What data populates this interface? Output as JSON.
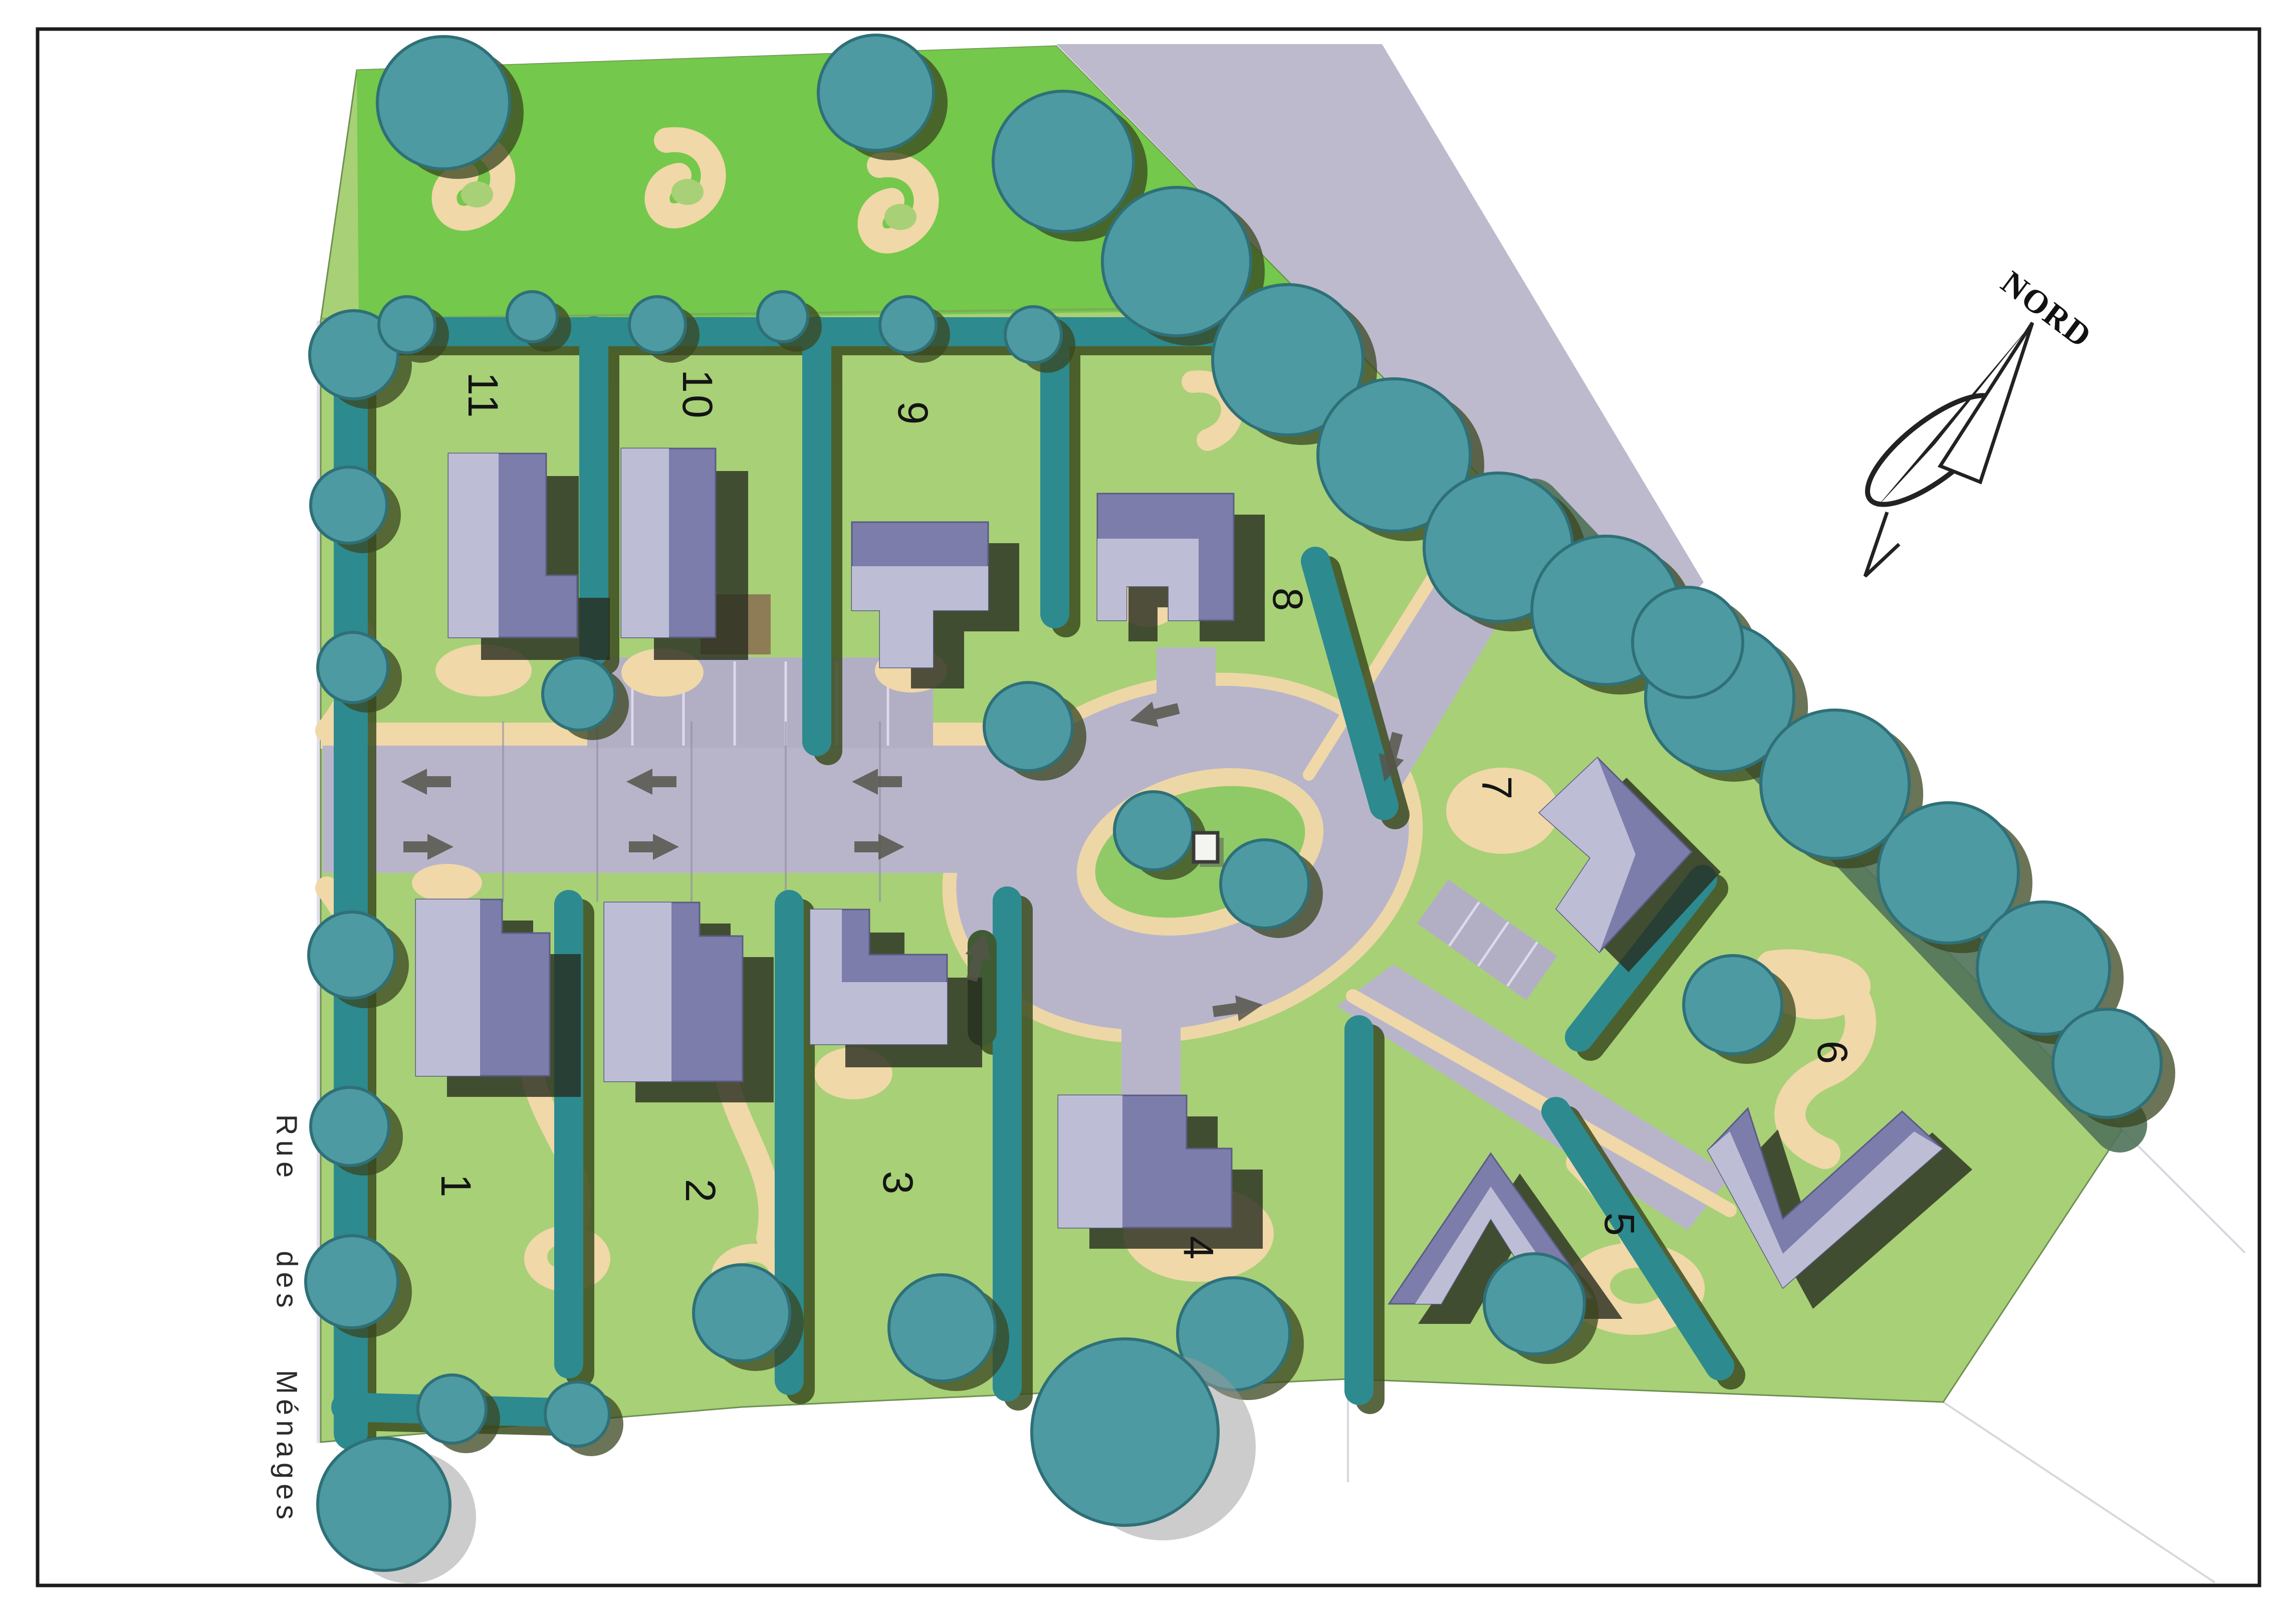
{
  "page": {
    "background": "#ffffff",
    "frame_color": "#1c1c1c"
  },
  "compass": {
    "label": "NORD"
  },
  "street": {
    "word1": "Rue",
    "word2": "des",
    "word3": "Ménages"
  },
  "lots": [
    {
      "number": "1"
    },
    {
      "number": "2"
    },
    {
      "number": "3"
    },
    {
      "number": "4"
    },
    {
      "number": "5"
    },
    {
      "number": "6"
    },
    {
      "number": "7"
    },
    {
      "number": "8"
    },
    {
      "number": "9"
    },
    {
      "number": "10"
    },
    {
      "number": "11"
    }
  ],
  "palette": {
    "grass": "#a8d077",
    "field_green": "#74c84b",
    "road": "#b8b5cb",
    "existing_road": "#bdbacd",
    "sand_path": "#f0d8a8",
    "hedge_teal": "#2d8a8f",
    "tree_teal": "#4e9aa3",
    "roof_light": "#bdbed6",
    "roof_dark": "#7c7dab",
    "shadow_olive": "#272c1e",
    "terrace_brown": "#8e7c57",
    "island_green": "#8fca67",
    "monument_white": "#f4f4f0"
  }
}
